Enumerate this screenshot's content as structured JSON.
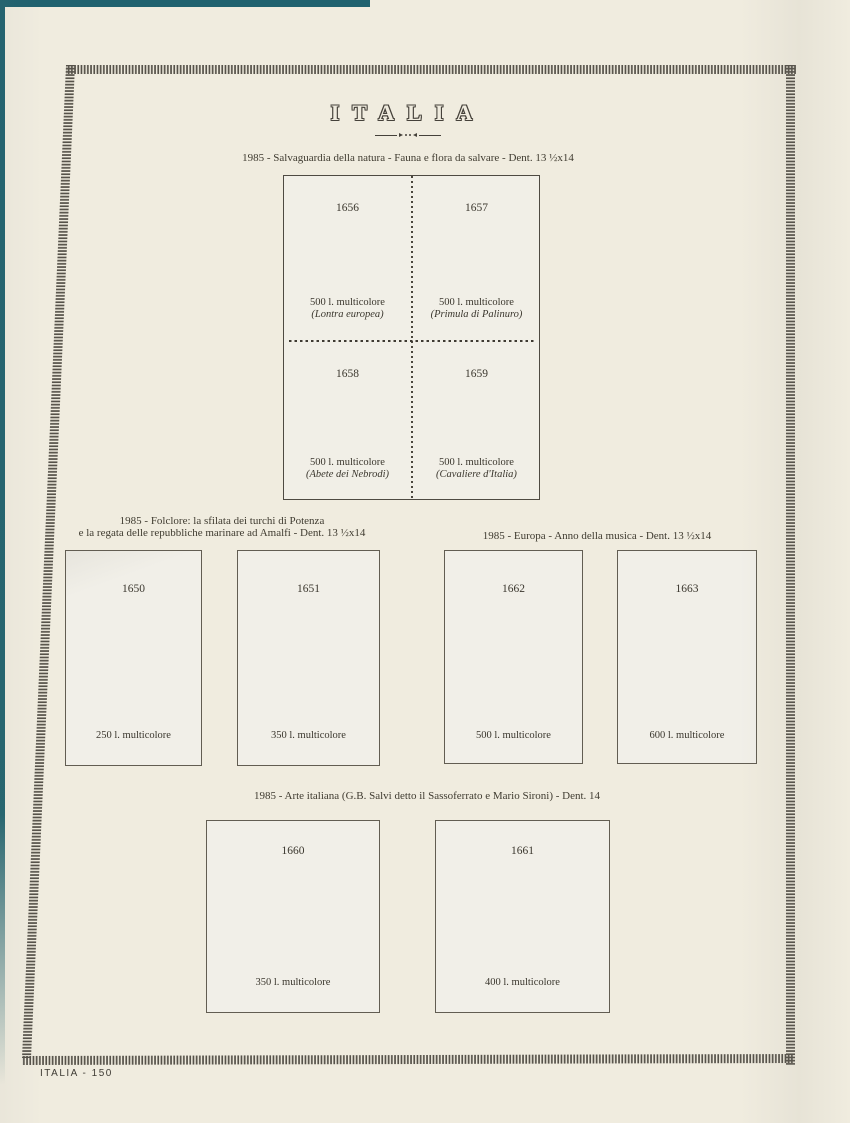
{
  "page": {
    "title": "ITALIA",
    "footer": "ITALIA - 150"
  },
  "colors": {
    "paper": "#f0ecdf",
    "ink": "#3b372e",
    "frame_fill": "#f1efe8",
    "hatch_border": "#56524a",
    "scan_edge_teal": "#20626f"
  },
  "sections": [
    {
      "name": "salvaguardia-natura",
      "heading_lines": [
        "1985 - Salvaguardia della natura - Fauna e flora da salvare - Dent. 13 ½x14"
      ],
      "stamps": [
        {
          "number": "1656",
          "value": "500 l. multicolore",
          "subtitle": "(Lontra europea)"
        },
        {
          "number": "1657",
          "value": "500 l. multicolore",
          "subtitle": "(Primula di Palinuro)"
        },
        {
          "number": "1658",
          "value": "500 l. multicolore",
          "subtitle": "(Abete dei Nebrodi)"
        },
        {
          "number": "1659",
          "value": "500 l. multicolore",
          "subtitle": "(Cavaliere d'Italia)"
        }
      ]
    },
    {
      "name": "folclore",
      "heading_lines": [
        "1985 - Folclore: la sfilata dei turchi di Potenza",
        "e la regata delle repubbliche marinare ad Amalfi - Dent. 13 ½x14"
      ],
      "stamps": [
        {
          "number": "1650",
          "value": "250 l. multicolore"
        },
        {
          "number": "1651",
          "value": "350 l. multicolore"
        }
      ]
    },
    {
      "name": "europa-musica",
      "heading_lines": [
        "1985 - Europa - Anno della musica - Dent. 13 ½x14"
      ],
      "stamps": [
        {
          "number": "1662",
          "value": "500 l. multicolore"
        },
        {
          "number": "1663",
          "value": "600 l. multicolore"
        }
      ]
    },
    {
      "name": "arte-italiana",
      "heading_lines": [
        "1985 - Arte italiana (G.B. Salvi detto il Sassoferrato e Mario Sironi) - Dent. 14"
      ],
      "stamps": [
        {
          "number": "1660",
          "value": "350 l. multicolore"
        },
        {
          "number": "1661",
          "value": "400 l. multicolore"
        }
      ]
    }
  ]
}
